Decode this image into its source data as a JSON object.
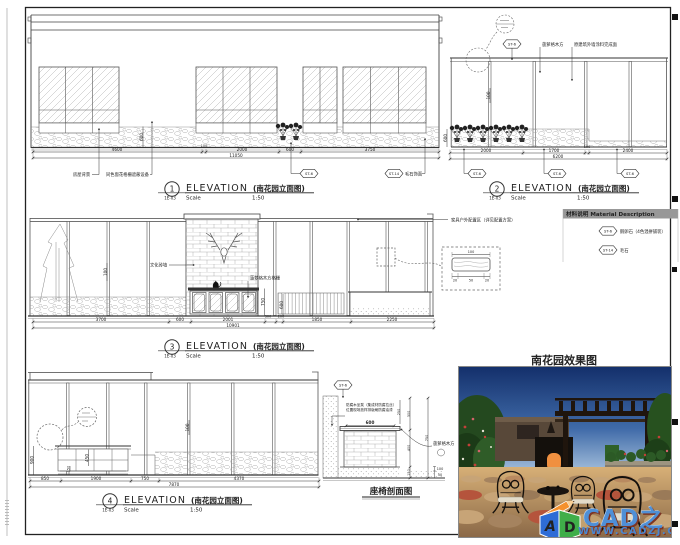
{
  "titles": {
    "elevation": "ELEVATION",
    "name_cn": "(南花园立面图)",
    "scale_label": "Scale",
    "scale_value": "1:50",
    "ref": "1E-03"
  },
  "tags": {
    "st6": "ST-6",
    "st14": "ST-14",
    "st14_desc": "毛石饰面"
  },
  "materials": {
    "header": "材料说明 Material Description",
    "rows": [
      {
        "tag": "ST-6",
        "desc": "鹅卵石（4色混拼铺装）"
      },
      {
        "tag": "ST-14",
        "desc": "毛石"
      }
    ]
  },
  "elev1": {
    "no": "1",
    "dims": [
      "4600",
      "100",
      "2000",
      "600",
      "3750"
    ],
    "total": "11050",
    "v600": "600",
    "label_house": "房屋背景",
    "label_screen": "同色窗花格栅遮蔽设备"
  },
  "elev2": {
    "no": "2",
    "dims": [
      "2000",
      "1700",
      "100",
      "2400"
    ],
    "total": "6200",
    "v600": "600",
    "v100": "100",
    "label_wood": "菠萝格木方",
    "label_house": "原建筑外墙涂料完成面"
  },
  "elev3": {
    "no": "3",
    "dims": [
      "3700",
      "600",
      "2001",
      "300",
      "200",
      "1850",
      "2250"
    ],
    "total": "10901",
    "v100": "100",
    "v750": "750",
    "v600": "600",
    "label_brick": "文化砖墙",
    "label_grille": "菠萝格木方格栅",
    "label_furniture": "家具户外配置区（详见配置方案）",
    "detail": {
      "w": "100",
      "d1": "20",
      "d2": "50",
      "d3": "20"
    }
  },
  "elev4": {
    "no": "4",
    "dims": [
      "850",
      "1900",
      "750",
      "4370"
    ],
    "total": "7870",
    "v900": "900",
    "v450": "450",
    "v150": "150",
    "v100": "100"
  },
  "seat": {
    "title": "座椅剖面图",
    "note1": "防腐木坐凳（集成材防腐拉丝）",
    "note2": "位置现场放样排版刷防腐油漆",
    "w600": "600",
    "d250": "250",
    "d300": "300",
    "d750": "750",
    "d400": "400",
    "d150": "150",
    "d100": "100",
    "d50": "50",
    "label_wood": "菠萝格木方"
  },
  "photo": {
    "title": "南花园效果图",
    "brand": "CAD之家",
    "url": "WWW.CADZJ.COM",
    "logo_a": "A",
    "logo_d": "D"
  }
}
